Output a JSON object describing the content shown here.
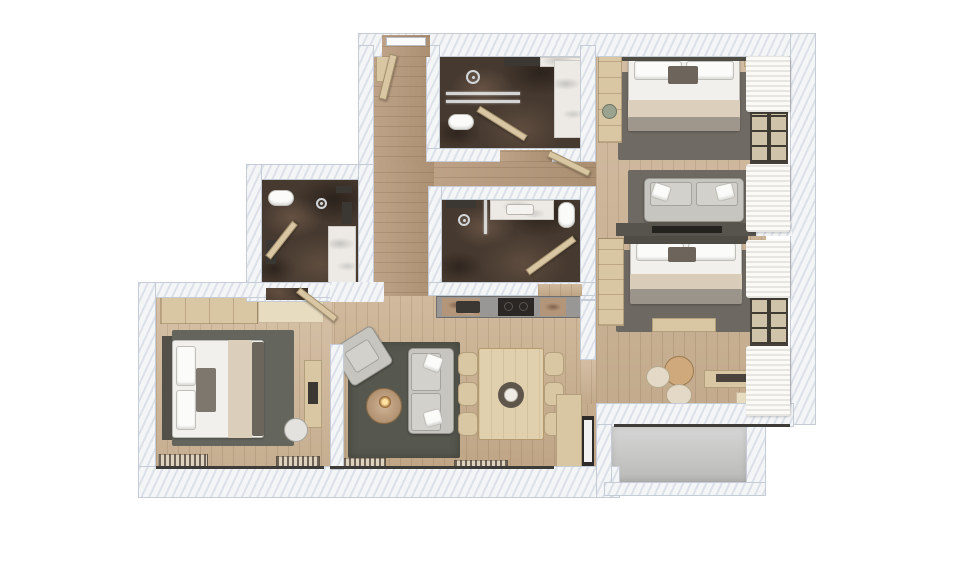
{
  "scene": {
    "type": "floor-plan-3d-render",
    "view": "top-down",
    "visible_text": "",
    "description": "Rendered top-down floor plan of a three-bedroom apartment with three bathrooms, kitchen, living-dining room and balcony"
  },
  "palette": {
    "background": "#ffffff",
    "wall": "#f4f5f7",
    "wall_hatch": "#d7dde5",
    "wood_light": "#c9ae8d",
    "wood_hall": "#b6987a",
    "marble_dark": "#46392f",
    "rug_living": "#56584f",
    "rug_bedroom": "#6e6862",
    "upholstery_gray": "#c6c5c0",
    "bedding_white": "#f1f0ed",
    "blanket_beige": "#dbcebb",
    "furniture_tan": "#d9c7a4",
    "balcony_concrete": "#c9c9c8",
    "window_frame": "#3e3a33"
  },
  "rooms": [
    {
      "id": "bedroom-1",
      "label": "bedroom",
      "furniture": [
        "double-bed",
        "rug",
        "sofa",
        "tv-wall",
        "wardrobe",
        "plant",
        "curtains"
      ]
    },
    {
      "id": "bedroom-2",
      "label": "bedroom",
      "furniture": [
        "double-bed",
        "rug",
        "bench",
        "round-table",
        "poufs",
        "console",
        "curtains"
      ]
    },
    {
      "id": "bedroom-3",
      "label": "bedroom",
      "furniture": [
        "double-bed",
        "rug",
        "wardrobe",
        "desk",
        "desk-chair",
        "radiators"
      ]
    },
    {
      "id": "bathroom-1",
      "label": "bathroom",
      "furniture": [
        "shower",
        "toilet",
        "vanity"
      ]
    },
    {
      "id": "bathroom-2",
      "label": "bathroom",
      "furniture": [
        "shower",
        "toilet",
        "vanity"
      ]
    },
    {
      "id": "bathroom-3",
      "label": "bathroom",
      "furniture": [
        "shower",
        "toilet",
        "vanity"
      ]
    },
    {
      "id": "kitchen",
      "label": "kitchen",
      "furniture": [
        "counter",
        "cooktop",
        "sink"
      ]
    },
    {
      "id": "living-dining",
      "label": "living-dining",
      "furniture": [
        "sofa",
        "armchair",
        "coffee-table",
        "dining-table",
        "dining-chairs",
        "cabinet",
        "radiators"
      ]
    },
    {
      "id": "entrance-hall",
      "label": "entrance",
      "furniture": [
        "entry-door",
        "shelf"
      ]
    },
    {
      "id": "balcony",
      "label": "balcony",
      "furniture": []
    }
  ],
  "icons": [
    {
      "name": "shower-head-icon",
      "shape": "ring-with-dot"
    },
    {
      "name": "floor-drain-icon",
      "shape": "ring-with-dot"
    }
  ]
}
